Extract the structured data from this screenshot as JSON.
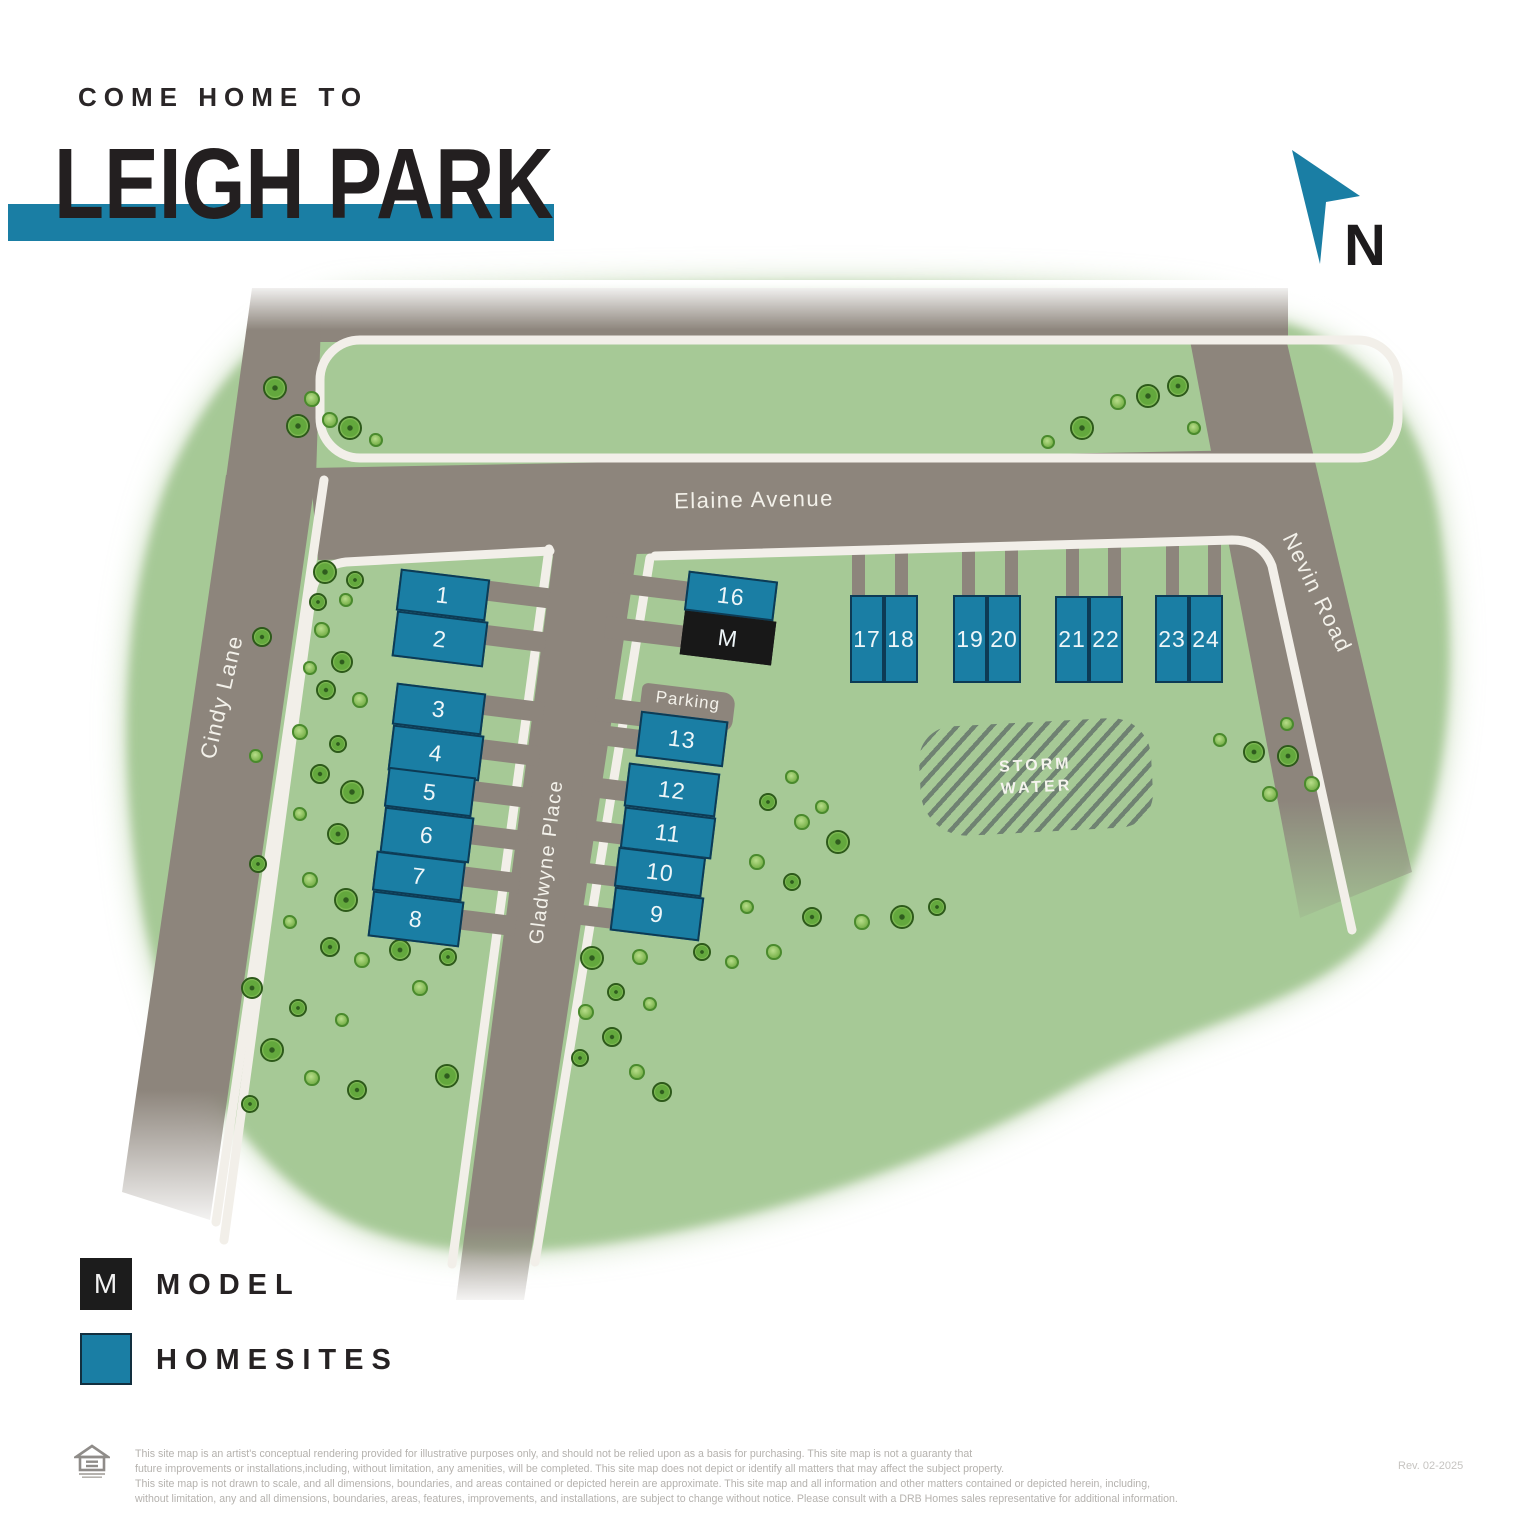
{
  "header": {
    "eyebrow": "COME HOME TO",
    "title": "LEIGH PARK",
    "accent_color": "#1a7ea4"
  },
  "compass": {
    "label": "N"
  },
  "map": {
    "street_labels": [
      {
        "name": "Elaine Avenue",
        "x": 754,
        "y": 500,
        "rot": -1,
        "size": 22
      },
      {
        "name": "Cindy Lane",
        "x": 222,
        "y": 697,
        "rot": -77,
        "size": 22
      },
      {
        "name": "Gladwyne Place",
        "x": 547,
        "y": 862,
        "rot": -83,
        "size": 20
      },
      {
        "name": "Nevin Road",
        "x": 1317,
        "y": 593,
        "rot": 64,
        "size": 22
      }
    ],
    "parking": {
      "label": "Parking",
      "x": 640,
      "y": 688,
      "w": 94,
      "h": 40,
      "rot": 7
    },
    "storm_water": {
      "lines": [
        "STORM",
        "WATER"
      ],
      "x": 920,
      "y": 722,
      "w": 232,
      "h": 110,
      "rot": -3
    },
    "lots": [
      {
        "label": "1",
        "type": "homesite",
        "x": 398,
        "y": 574,
        "w": 90,
        "h": 42,
        "rot": 7
      },
      {
        "label": "2",
        "type": "homesite",
        "x": 394,
        "y": 616,
        "w": 92,
        "h": 46,
        "rot": 7
      },
      {
        "label": "3",
        "type": "homesite",
        "x": 394,
        "y": 688,
        "w": 90,
        "h": 42,
        "rot": 7
      },
      {
        "label": "4",
        "type": "homesite",
        "x": 390,
        "y": 730,
        "w": 92,
        "h": 46,
        "rot": 7
      },
      {
        "label": "5",
        "type": "homesite",
        "x": 386,
        "y": 772,
        "w": 88,
        "h": 40,
        "rot": 7
      },
      {
        "label": "6",
        "type": "homesite",
        "x": 382,
        "y": 812,
        "w": 90,
        "h": 46,
        "rot": 7
      },
      {
        "label": "7",
        "type": "homesite",
        "x": 374,
        "y": 856,
        "w": 90,
        "h": 40,
        "rot": 7
      },
      {
        "label": "8",
        "type": "homesite",
        "x": 370,
        "y": 896,
        "w": 92,
        "h": 46,
        "rot": 7
      },
      {
        "label": "16",
        "type": "homesite",
        "x": 686,
        "y": 576,
        "w": 90,
        "h": 40,
        "rot": 7
      },
      {
        "label": "M",
        "type": "model",
        "x": 682,
        "y": 616,
        "w": 92,
        "h": 44,
        "rot": 7
      },
      {
        "label": "13",
        "type": "homesite",
        "x": 638,
        "y": 716,
        "w": 88,
        "h": 46,
        "rot": 7
      },
      {
        "label": "12",
        "type": "homesite",
        "x": 626,
        "y": 768,
        "w": 92,
        "h": 44,
        "rot": 7
      },
      {
        "label": "11",
        "type": "homesite",
        "x": 622,
        "y": 812,
        "w": 92,
        "h": 42,
        "rot": 7
      },
      {
        "label": "10",
        "type": "homesite",
        "x": 616,
        "y": 852,
        "w": 88,
        "h": 40,
        "rot": 7
      },
      {
        "label": "9",
        "type": "homesite",
        "x": 612,
        "y": 892,
        "w": 90,
        "h": 44,
        "rot": 7
      },
      {
        "label": "17",
        "type": "homesite",
        "x": 850,
        "y": 595,
        "w": 34,
        "h": 88,
        "rot": 0
      },
      {
        "label": "18",
        "type": "homesite",
        "x": 884,
        "y": 595,
        "w": 34,
        "h": 88,
        "rot": 0
      },
      {
        "label": "19",
        "type": "homesite",
        "x": 953,
        "y": 595,
        "w": 34,
        "h": 88,
        "rot": 0
      },
      {
        "label": "20",
        "type": "homesite",
        "x": 987,
        "y": 595,
        "w": 34,
        "h": 88,
        "rot": 0
      },
      {
        "label": "21",
        "type": "homesite",
        "x": 1055,
        "y": 596,
        "w": 34,
        "h": 87,
        "rot": 0
      },
      {
        "label": "22",
        "type": "homesite",
        "x": 1089,
        "y": 596,
        "w": 34,
        "h": 87,
        "rot": 0
      },
      {
        "label": "23",
        "type": "homesite",
        "x": 1155,
        "y": 595,
        "w": 34,
        "h": 88,
        "rot": 0
      },
      {
        "label": "24",
        "type": "homesite",
        "x": 1189,
        "y": 595,
        "w": 34,
        "h": 88,
        "rot": 0
      }
    ],
    "driveways": [
      {
        "x": 478,
        "y": 584,
        "w": 72,
        "h": 20,
        "rot": 7,
        "layer": "over"
      },
      {
        "x": 474,
        "y": 628,
        "w": 72,
        "h": 20,
        "rot": 7,
        "layer": "over"
      },
      {
        "x": 472,
        "y": 698,
        "w": 72,
        "h": 20,
        "rot": 7,
        "layer": "over"
      },
      {
        "x": 468,
        "y": 742,
        "w": 72,
        "h": 20,
        "rot": 7,
        "layer": "over"
      },
      {
        "x": 460,
        "y": 784,
        "w": 72,
        "h": 20,
        "rot": 7,
        "layer": "over"
      },
      {
        "x": 456,
        "y": 827,
        "w": 72,
        "h": 20,
        "rot": 7,
        "layer": "over"
      },
      {
        "x": 448,
        "y": 869,
        "w": 72,
        "h": 20,
        "rot": 7,
        "layer": "over"
      },
      {
        "x": 444,
        "y": 912,
        "w": 72,
        "h": 20,
        "rot": 7,
        "layer": "over"
      },
      {
        "x": 610,
        "y": 577,
        "w": 82,
        "h": 20,
        "rot": 7,
        "layer": "over"
      },
      {
        "x": 605,
        "y": 621,
        "w": 82,
        "h": 22,
        "rot": 7,
        "layer": "over"
      },
      {
        "x": 596,
        "y": 700,
        "w": 52,
        "h": 24,
        "rot": 7,
        "layer": "over"
      },
      {
        "x": 590,
        "y": 727,
        "w": 52,
        "h": 20,
        "rot": 7,
        "layer": "over"
      },
      {
        "x": 582,
        "y": 779,
        "w": 50,
        "h": 20,
        "rot": 7,
        "layer": "over"
      },
      {
        "x": 577,
        "y": 822,
        "w": 50,
        "h": 20,
        "rot": 7,
        "layer": "over"
      },
      {
        "x": 570,
        "y": 864,
        "w": 50,
        "h": 20,
        "rot": 7,
        "layer": "over"
      },
      {
        "x": 565,
        "y": 906,
        "w": 50,
        "h": 20,
        "rot": 7,
        "layer": "over"
      },
      {
        "x": 852,
        "y": 512,
        "w": 13,
        "h": 88,
        "rot": 0,
        "layer": "under"
      },
      {
        "x": 895,
        "y": 512,
        "w": 13,
        "h": 88,
        "rot": 0,
        "layer": "under"
      },
      {
        "x": 962,
        "y": 512,
        "w": 13,
        "h": 88,
        "rot": 0,
        "layer": "under"
      },
      {
        "x": 1005,
        "y": 512,
        "w": 13,
        "h": 88,
        "rot": 0,
        "layer": "under"
      },
      {
        "x": 1066,
        "y": 513,
        "w": 13,
        "h": 87,
        "rot": 0,
        "layer": "under"
      },
      {
        "x": 1108,
        "y": 513,
        "w": 13,
        "h": 87,
        "rot": 0,
        "layer": "under"
      },
      {
        "x": 1166,
        "y": 512,
        "w": 13,
        "h": 88,
        "rot": 0,
        "layer": "under"
      },
      {
        "x": 1208,
        "y": 512,
        "w": 13,
        "h": 88,
        "rot": 0,
        "layer": "under"
      }
    ],
    "trees": [
      [
        275,
        388,
        12,
        1
      ],
      [
        312,
        399,
        8,
        0
      ],
      [
        298,
        426,
        12,
        1
      ],
      [
        330,
        420,
        8,
        0
      ],
      [
        350,
        428,
        12,
        1
      ],
      [
        376,
        440,
        7,
        0
      ],
      [
        1082,
        428,
        12,
        1
      ],
      [
        1118,
        402,
        8,
        0
      ],
      [
        1148,
        396,
        12,
        1
      ],
      [
        1178,
        386,
        11,
        1
      ],
      [
        1194,
        428,
        7,
        0
      ],
      [
        1048,
        442,
        7,
        0
      ],
      [
        325,
        572,
        12,
        1
      ],
      [
        355,
        580,
        9,
        1
      ],
      [
        262,
        637,
        10,
        1
      ],
      [
        318,
        602,
        9,
        1
      ],
      [
        346,
        600,
        7,
        0
      ],
      [
        322,
        630,
        8,
        0
      ],
      [
        342,
        662,
        11,
        1
      ],
      [
        310,
        668,
        7,
        0
      ],
      [
        326,
        690,
        10,
        1
      ],
      [
        360,
        700,
        8,
        0
      ],
      [
        300,
        732,
        8,
        0
      ],
      [
        338,
        744,
        9,
        1
      ],
      [
        256,
        756,
        7,
        0
      ],
      [
        320,
        774,
        10,
        1
      ],
      [
        352,
        792,
        12,
        1
      ],
      [
        300,
        814,
        7,
        0
      ],
      [
        338,
        834,
        11,
        1
      ],
      [
        258,
        864,
        9,
        1
      ],
      [
        310,
        880,
        8,
        0
      ],
      [
        346,
        900,
        12,
        1
      ],
      [
        290,
        922,
        7,
        0
      ],
      [
        330,
        947,
        10,
        1
      ],
      [
        362,
        960,
        8,
        0
      ],
      [
        252,
        988,
        11,
        1
      ],
      [
        298,
        1008,
        9,
        1
      ],
      [
        342,
        1020,
        7,
        0
      ],
      [
        272,
        1050,
        12,
        1
      ],
      [
        312,
        1078,
        8,
        0
      ],
      [
        357,
        1090,
        10,
        1
      ],
      [
        250,
        1104,
        9,
        1
      ],
      [
        400,
        950,
        11,
        1
      ],
      [
        448,
        957,
        9,
        1
      ],
      [
        420,
        988,
        8,
        0
      ],
      [
        447,
        1076,
        12,
        1
      ],
      [
        580,
        1058,
        9,
        1
      ],
      [
        592,
        958,
        12,
        1
      ],
      [
        640,
        957,
        8,
        0
      ],
      [
        616,
        992,
        9,
        1
      ],
      [
        586,
        1012,
        8,
        0
      ],
      [
        650,
        1004,
        7,
        0
      ],
      [
        612,
        1037,
        10,
        1
      ],
      [
        637,
        1072,
        8,
        0
      ],
      [
        662,
        1092,
        10,
        1
      ],
      [
        768,
        802,
        9,
        1
      ],
      [
        792,
        777,
        7,
        0
      ],
      [
        802,
        822,
        8,
        0
      ],
      [
        838,
        842,
        12,
        1
      ],
      [
        822,
        807,
        7,
        0
      ],
      [
        757,
        862,
        8,
        0
      ],
      [
        792,
        882,
        9,
        1
      ],
      [
        747,
        907,
        7,
        0
      ],
      [
        812,
        917,
        10,
        1
      ],
      [
        862,
        922,
        8,
        0
      ],
      [
        902,
        917,
        12,
        1
      ],
      [
        937,
        907,
        9,
        1
      ],
      [
        774,
        952,
        8,
        0
      ],
      [
        702,
        952,
        9,
        1
      ],
      [
        732,
        962,
        7,
        0
      ],
      [
        1220,
        740,
        7,
        0
      ],
      [
        1254,
        752,
        11,
        1
      ],
      [
        1287,
        724,
        7,
        0
      ],
      [
        1288,
        756,
        11,
        1
      ],
      [
        1312,
        784,
        8,
        0
      ],
      [
        1270,
        794,
        8,
        0
      ]
    ]
  },
  "legend": {
    "items": [
      {
        "symbol": "M",
        "label": "MODEL",
        "type": "model",
        "color": "#1c1c1c"
      },
      {
        "symbol": "",
        "label": "HOMESITES",
        "type": "homesite",
        "color": "#1a7ea4"
      }
    ]
  },
  "footer": {
    "disclaimer_lines": [
      "This site map is an artist's conceptual rendering provided for illustrative purposes only, and should not be relied upon as a basis for purchasing. This site map is not a guaranty that",
      "future improvements or installations,including, without limitation, any amenities, will be completed. This site map does not depict or identify all matters that may affect the subject property.",
      "This site map is not drawn to scale, and all dimensions, boundaries, and areas contained or depicted herein are approximate. This site map and all information and other matters contained or depicted herein, including,",
      "without limitation, any and all dimensions, boundaries, areas, features, improvements, and installations, are subject to change without notice. Please consult with a DRB Homes sales representative for additional information."
    ],
    "rev": "Rev. 02-2025"
  }
}
